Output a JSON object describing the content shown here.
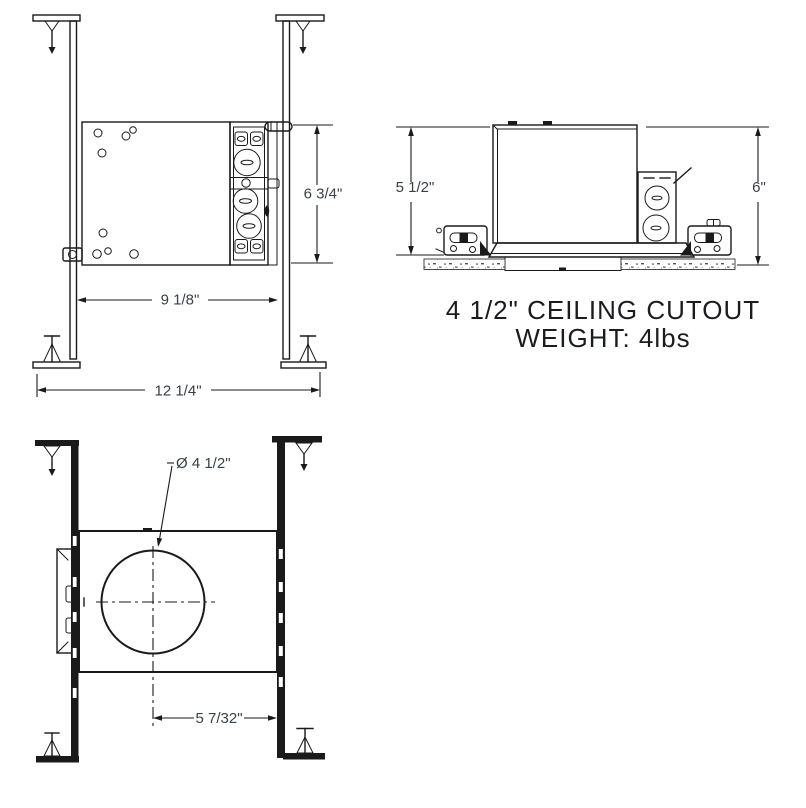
{
  "front_view": {
    "height": "6 3/4\"",
    "width": "9 1/8\"",
    "overall_width": "12 1/4\""
  },
  "side_view": {
    "housing_height": "5 1/2\"",
    "overall_height": "6\""
  },
  "caption": {
    "line1": "4 1/2\" CEILING CUTOUT",
    "line2": "WEIGHT: 4lbs"
  },
  "bottom_view": {
    "cutout_diameter": "Ø 4 1/2\"",
    "center_to_edge": "5 7/32\""
  },
  "colors": {
    "line": "#1a1a1a",
    "dim_text": "#3a4047",
    "caption": "#1b1c1f",
    "bg": "#ffffff"
  }
}
